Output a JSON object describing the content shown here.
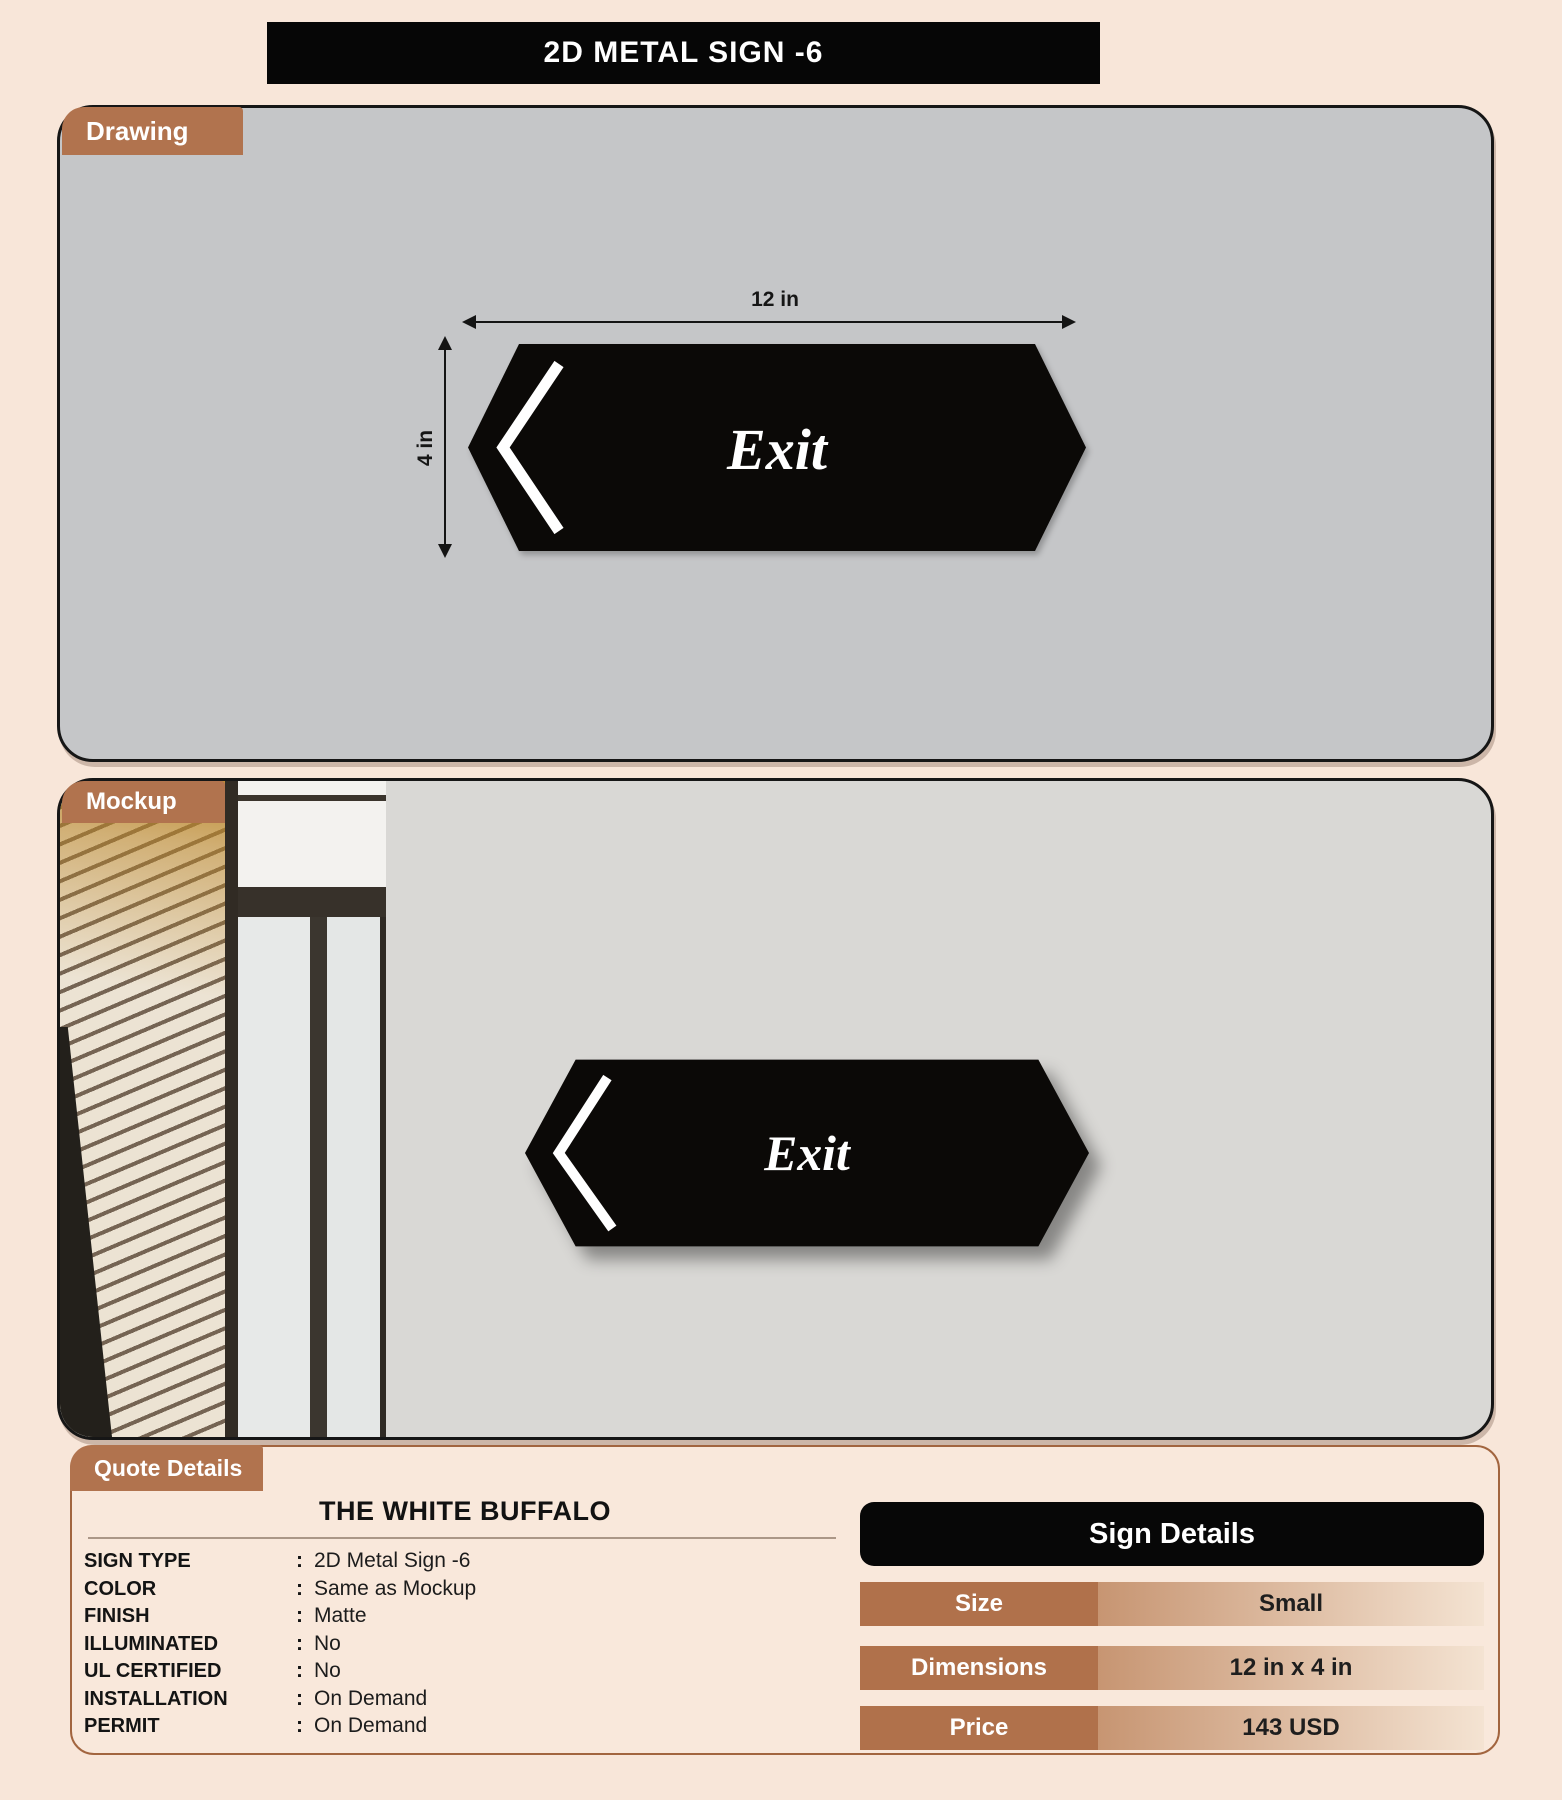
{
  "title": "2D METAL SIGN -6",
  "colors": {
    "background": "#f8e6d9",
    "accent_brown": "#b1734e",
    "drawing_panel_gray": "#c5c6c8",
    "mockup_wall_gray": "#d9d8d5",
    "sign_black": "#0b0907",
    "table_row_gradient_start": "#c79572",
    "table_row_gradient_end": "#f4e3d2"
  },
  "drawing": {
    "tab": "Drawing",
    "width_dim": "12 in",
    "height_dim": "4 in",
    "sign_text": "Exit"
  },
  "mockup": {
    "tab": "Mockup",
    "sign_text": "Exit"
  },
  "quote": {
    "tab": "Quote Details",
    "company": "THE WHITE BUFFALO",
    "fields": [
      {
        "label": "SIGN TYPE",
        "value": "2D Metal Sign -6"
      },
      {
        "label": "COLOR",
        "value": "Same as Mockup"
      },
      {
        "label": "FINISH",
        "value": "Matte"
      },
      {
        "label": "ILLUMINATED",
        "value": "No"
      },
      {
        "label": "UL CERTIFIED",
        "value": "No"
      },
      {
        "label": "INSTALLATION",
        "value": "On Demand"
      },
      {
        "label": "PERMIT",
        "value": "On Demand"
      }
    ]
  },
  "sign_details": {
    "title": "Sign Details",
    "rows": [
      {
        "label": "Size",
        "value": "Small"
      },
      {
        "label": "Dimensions",
        "value": "12 in x 4 in"
      },
      {
        "label": "Price",
        "value": "143 USD"
      }
    ]
  }
}
